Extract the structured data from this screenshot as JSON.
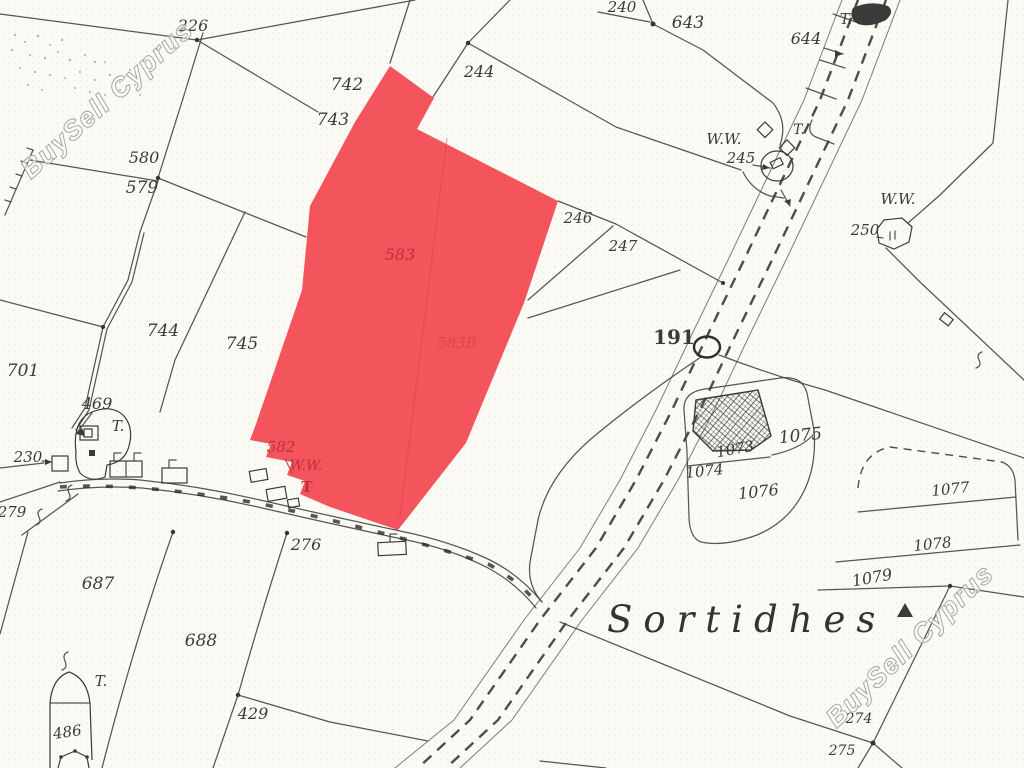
{
  "place_name": "Sortidhes",
  "watermarks": {
    "top_left": "BuySell Cyprus",
    "bottom_right": "BuySell Cyprus"
  },
  "highlight": {
    "parcel": "583",
    "fill_color": "#f4555c",
    "label_color": "#c22f3c"
  },
  "colors": {
    "paper": "#fbfaf4",
    "ink": "#3f3f3f"
  },
  "map_labels": [
    {
      "t": "226",
      "x": 193,
      "y": 31,
      "s": 16
    },
    {
      "t": "742",
      "x": 347,
      "y": 90,
      "s": 17
    },
    {
      "t": "743",
      "x": 333,
      "y": 125,
      "s": 17
    },
    {
      "t": "580",
      "x": 144,
      "y": 163,
      "s": 16
    },
    {
      "t": "579",
      "x": 142,
      "y": 193,
      "s": 17
    },
    {
      "t": "244",
      "x": 479,
      "y": 77,
      "s": 16
    },
    {
      "t": "240",
      "x": 622,
      "y": 12,
      "s": 15
    },
    {
      "t": "643",
      "x": 688,
      "y": 28,
      "s": 17
    },
    {
      "t": "T.",
      "x": 846,
      "y": 24,
      "s": 15
    },
    {
      "t": "644",
      "x": 806,
      "y": 44,
      "s": 16
    },
    {
      "t": "W.W.",
      "x": 724,
      "y": 144,
      "s": 15
    },
    {
      "t": "T.",
      "x": 799,
      "y": 134,
      "s": 14
    },
    {
      "t": "245",
      "x": 741,
      "y": 163,
      "s": 15
    },
    {
      "t": "W.W.",
      "x": 898,
      "y": 204,
      "s": 15
    },
    {
      "t": "250",
      "x": 865,
      "y": 235,
      "s": 15
    },
    {
      "t": "246",
      "x": 578,
      "y": 223,
      "s": 15
    },
    {
      "t": "247",
      "x": 623,
      "y": 251,
      "s": 15
    },
    {
      "t": "191",
      "x": 674,
      "y": 344,
      "s": 20,
      "b": true
    },
    {
      "t": "701",
      "x": 23,
      "y": 376,
      "s": 17
    },
    {
      "t": "744",
      "x": 163,
      "y": 336,
      "s": 17
    },
    {
      "t": "745",
      "x": 242,
      "y": 349,
      "s": 17
    },
    {
      "t": "469",
      "x": 97,
      "y": 409,
      "s": 16
    },
    {
      "t": "T.",
      "x": 118,
      "y": 431,
      "s": 15
    },
    {
      "t": "230",
      "x": 28,
      "y": 462,
      "s": 15
    },
    {
      "t": "279",
      "x": 12,
      "y": 517,
      "s": 15
    },
    {
      "t": "276",
      "x": 306,
      "y": 550,
      "s": 16
    },
    {
      "t": "687",
      "x": 98,
      "y": 589,
      "s": 17
    },
    {
      "t": "688",
      "x": 201,
      "y": 646,
      "s": 17
    },
    {
      "t": "T.",
      "x": 101,
      "y": 686,
      "s": 15
    },
    {
      "t": "486",
      "x": 68,
      "y": 737,
      "s": 15,
      "r": -8
    },
    {
      "t": "429",
      "x": 253,
      "y": 719,
      "s": 16
    },
    {
      "t": "1073",
      "x": 736,
      "y": 454,
      "s": 15,
      "r": -10
    },
    {
      "t": "1074",
      "x": 705,
      "y": 476,
      "s": 15,
      "r": -6
    },
    {
      "t": "1075",
      "x": 801,
      "y": 441,
      "s": 17,
      "r": -6
    },
    {
      "t": "1076",
      "x": 759,
      "y": 497,
      "s": 16,
      "r": -6
    },
    {
      "t": "1077",
      "x": 951,
      "y": 494,
      "s": 15,
      "r": -6
    },
    {
      "t": "1078",
      "x": 933,
      "y": 549,
      "s": 15,
      "r": -6
    },
    {
      "t": "1079",
      "x": 873,
      "y": 583,
      "s": 16,
      "r": -10
    },
    {
      "t": "274",
      "x": 859,
      "y": 723,
      "s": 14
    },
    {
      "t": "275",
      "x": 842,
      "y": 755,
      "s": 14
    },
    {
      "t": "583",
      "x": 400,
      "y": 260,
      "s": 16,
      "c": "red"
    },
    {
      "t": "583B",
      "x": 457,
      "y": 348,
      "s": 15,
      "c": "red",
      "o": 0.45
    },
    {
      "t": "582",
      "x": 281,
      "y": 452,
      "s": 15,
      "c": "red"
    },
    {
      "t": "W.W.",
      "x": 306,
      "y": 470,
      "s": 14,
      "c": "red"
    },
    {
      "t": "T",
      "x": 307,
      "y": 492,
      "s": 15,
      "c": "red",
      "b": true
    }
  ]
}
